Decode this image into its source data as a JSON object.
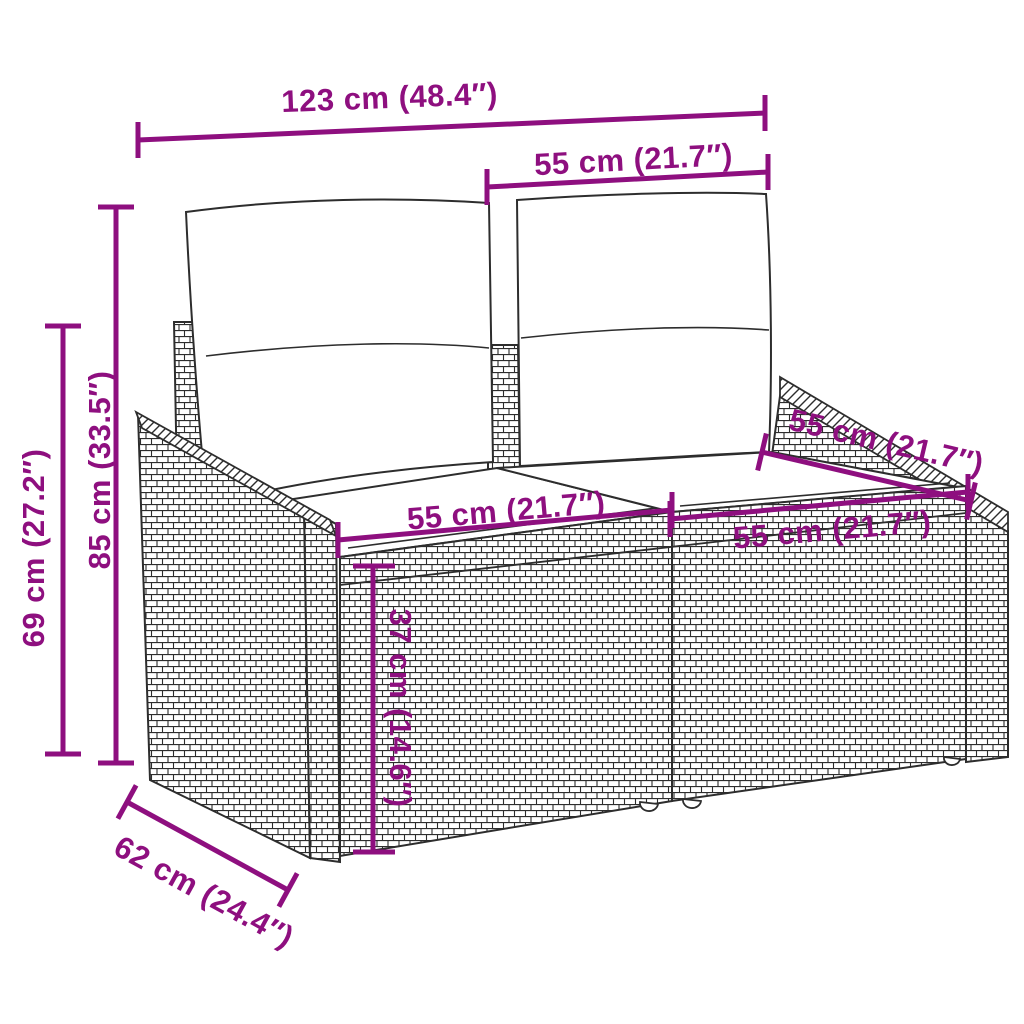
{
  "figure": {
    "title": "Rattan 2-seater garden sofa with cushions — dimensions diagram",
    "units": [
      "cm",
      "inches"
    ]
  },
  "colors": {
    "dimension": "#8E0F7F",
    "line_art": "#2d2d2d",
    "background": "#ffffff",
    "cushion": "#ffffff"
  },
  "dimensions": {
    "overall_width": {
      "label": "123 cm (48.4″)",
      "value_cm": 123,
      "value_in": 48.4
    },
    "backrest_width": {
      "label": "55 cm (21.7″)",
      "value_cm": 55,
      "value_in": 21.7
    },
    "overall_height": {
      "label": "85 cm (33.5″)",
      "value_cm": 85,
      "value_in": 33.5
    },
    "armrest_height": {
      "label": "69 cm (27.2″)",
      "value_cm": 69,
      "value_in": 27.2
    },
    "seat_depth_diagonal": {
      "label": "55 cm (21.7″)",
      "value_cm": 55,
      "value_in": 21.7
    },
    "seat_width_left": {
      "label": "55 cm (21.7″)",
      "value_cm": 55,
      "value_in": 21.7
    },
    "seat_width_right": {
      "label": "55 cm (21.7″)",
      "value_cm": 55,
      "value_in": 21.7
    },
    "seat_height": {
      "label": "37 cm (14.6″)",
      "value_cm": 37,
      "value_in": 14.6
    },
    "overall_depth": {
      "label": "62 cm (24.4″)",
      "value_cm": 62,
      "value_in": 24.4
    }
  }
}
